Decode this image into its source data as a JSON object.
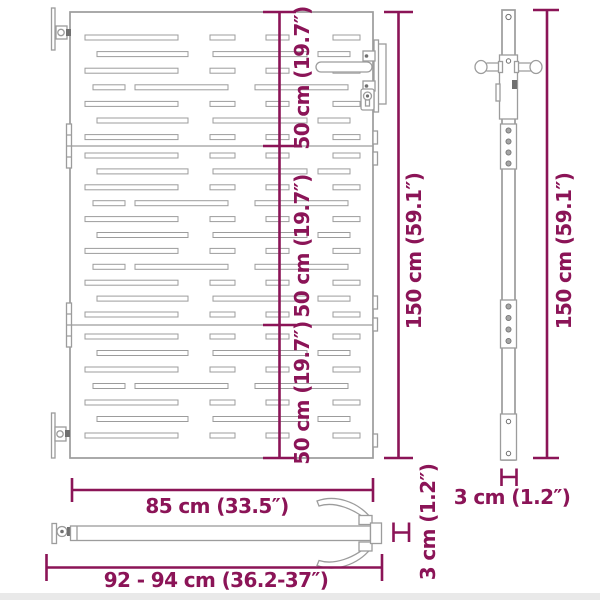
{
  "colors": {
    "dimension": "#8b1457",
    "line": "#9c9c9c",
    "line_dark": "#707070",
    "bottom_strip": "#e9e9e9"
  },
  "labels": {
    "section_50cm": "50 cm (19.7″)",
    "gate_height": "150 cm (59.1″)",
    "post_height": "150 cm (59.1″)",
    "gate_width": "85 cm (33.5″)",
    "overall_width": "92 - 94 cm (36.2-37″)",
    "bar_thickness": "3 cm (1.2″)",
    "post_thickness": "3 cm (1.2″)"
  },
  "front_view": {
    "gate": {
      "x": 70,
      "y": 12,
      "width": 303,
      "height": 446
    },
    "slat_height": 5,
    "patterns": {
      "A": [
        [
          15,
          93
        ],
        [
          140,
          25
        ],
        [
          196,
          23
        ],
        [
          263,
          27
        ]
      ],
      "B": [
        [
          27,
          91
        ],
        [
          143,
          94
        ],
        [
          248,
          32
        ]
      ],
      "C": [
        [
          23,
          32
        ],
        [
          65,
          93
        ],
        [
          185,
          93
        ]
      ]
    },
    "sections": [
      {
        "sequence": [
          "A",
          "B",
          "A",
          "C",
          "A",
          "B",
          "A"
        ],
        "y_start": 35,
        "y_step": 16.6
      },
      {
        "sequence": [
          "A",
          "B",
          "A",
          "C",
          "A",
          "B",
          "A",
          "C",
          "A",
          "B",
          "A"
        ],
        "y_start": 153,
        "y_step": 15.9
      },
      {
        "sequence": [
          "A",
          "B",
          "A",
          "C",
          "A",
          "B",
          "A"
        ],
        "y_start": 334,
        "y_step": 16.5
      }
    ]
  }
}
